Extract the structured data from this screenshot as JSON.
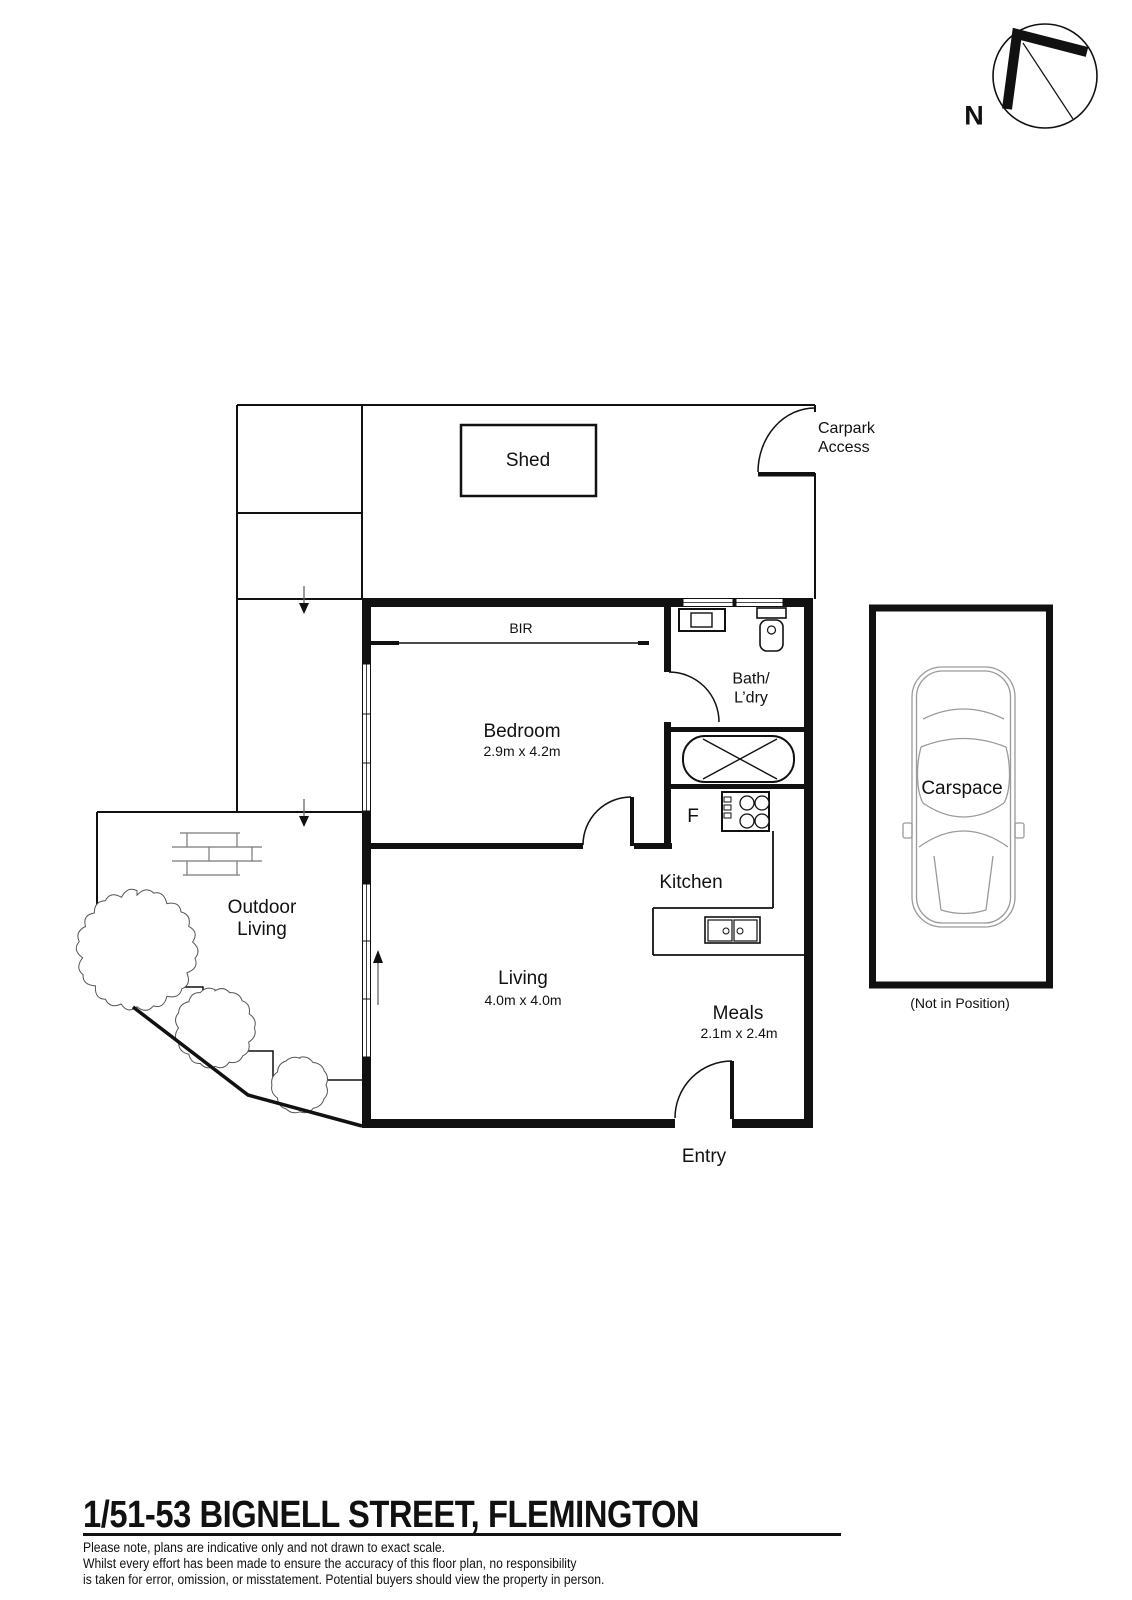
{
  "compass": {
    "north_label": "N"
  },
  "site": {
    "shed_label": "Shed",
    "carpark_access_label": "Carpark\nAccess",
    "outdoor_living_label": "Outdoor\nLiving"
  },
  "rooms": {
    "bedroom": {
      "name": "Bedroom",
      "dimensions": "2.9m x 4.2m"
    },
    "living": {
      "name": "Living",
      "dimensions": "4.0m x 4.0m"
    },
    "meals": {
      "name": "Meals",
      "dimensions": "2.1m x 2.4m"
    },
    "kitchen": {
      "name": "Kitchen"
    },
    "bath_laundry": {
      "name": "Bath/\nL’dry"
    },
    "bir": {
      "name": "BIR"
    },
    "fridge": {
      "name": "F"
    },
    "entry": {
      "name": "Entry"
    }
  },
  "carspace": {
    "name": "Carspace",
    "note": "(Not in Position)"
  },
  "footer": {
    "address": "1/51-53 BIGNELL STREET, FLEMINGTON",
    "disclaimer_lines": [
      "Please note, plans are indicative only and not drawn to exact scale.",
      "Whilst every effort has been made to ensure the accuracy of this floor plan, no responsibility",
      "is taken for error, omission, or misstatement. Potential buyers should view the property in person."
    ]
  }
}
